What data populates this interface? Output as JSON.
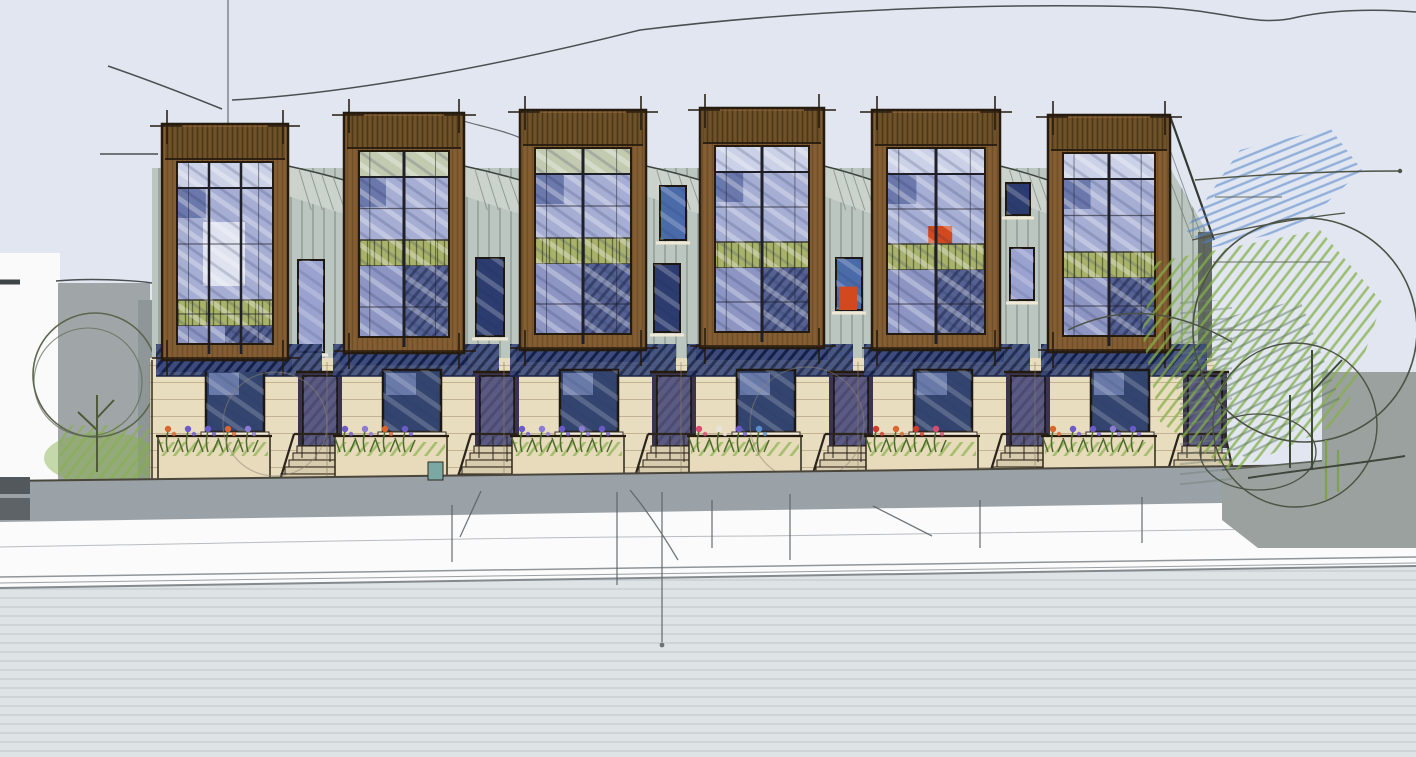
{
  "scene": {
    "type": "architectural-concept-sketch",
    "subject": "six-unit-townhouse-row-street-elevation",
    "unit_count": 6
  },
  "palette": {
    "sky": "#e1e6f1",
    "paper": "#fafafa",
    "siding": "#bcc6c0",
    "sidingLight": "#ccd4ce",
    "wood": "#855f33",
    "woodDark": "#6e5128",
    "cream": "#e9ddc0",
    "glass": "#a6aed4",
    "glassLight": "#cbd1e6",
    "glassDeep": "#8d95c3",
    "louverGreen": "#a9b26b",
    "navy": "#3b4a7c",
    "navyInk": "#141f46",
    "orange": "#d2491f",
    "door": "#6b6287",
    "doorShadow": "#3a3450",
    "step": "#d8ccae",
    "planter": "#e7dbbc",
    "sidewalk": "#9ba2a7",
    "street": "#fbfbfc",
    "foreground": "#dee3e5",
    "ink": "#241a0e",
    "pen": "#4a4e50",
    "treeOutline": "#4c5244",
    "treeGreen": "#84b048",
    "skyScribble": "#5082c8",
    "leftBuilding": "#a0a6a7",
    "rightWall": "#9aa19e",
    "flowerPurple": "#6b5bc9",
    "flowerLilac": "#8a7bd4",
    "flowerOrange": "#d9652f",
    "flowerRed": "#cf3b2a",
    "flowerPink": "#d94b70",
    "flowerWhite": "#e8e4da",
    "flowerBlue": "#5a8ec9"
  },
  "townhouses": {
    "row_left": 150,
    "row_right": 1212,
    "unit_width": 177,
    "ground_top": 358,
    "ground_bottom": 482,
    "bays": [
      {
        "x": 162,
        "w": 126,
        "top": 124,
        "bottom": 360,
        "louver": 300,
        "cols": 3,
        "topTint": false,
        "accent": false,
        "whitePanel": true
      },
      {
        "x": 344,
        "w": 120,
        "top": 113,
        "bottom": 353,
        "louver": 240,
        "cols": 2,
        "topTint": true,
        "accent": false,
        "whitePanel": false
      },
      {
        "x": 520,
        "w": 126,
        "top": 110,
        "bottom": 350,
        "louver": 238,
        "cols": 2,
        "topTint": true,
        "accent": false,
        "whitePanel": false
      },
      {
        "x": 700,
        "w": 124,
        "top": 108,
        "bottom": 348,
        "louver": 242,
        "cols": 2,
        "topTint": false,
        "accent": false,
        "whitePanel": false
      },
      {
        "x": 872,
        "w": 128,
        "top": 110,
        "bottom": 350,
        "louver": 244,
        "cols": 2,
        "topTint": false,
        "accent": true,
        "whitePanel": false
      },
      {
        "x": 1048,
        "w": 122,
        "top": 115,
        "bottom": 352,
        "louver": 252,
        "cols": 2,
        "topTint": false,
        "accent": false,
        "whitePanel": false
      }
    ],
    "gap_windows": [
      {
        "x": 298,
        "y": 260,
        "w": 26,
        "h": 92,
        "tone": "lavender",
        "accent": false
      },
      {
        "x": 476,
        "y": 258,
        "w": 28,
        "h": 78,
        "tone": "navy",
        "accent": false
      },
      {
        "x": 660,
        "y": 186,
        "w": 26,
        "h": 54,
        "tone": "blue",
        "accent": false
      },
      {
        "x": 654,
        "y": 264,
        "w": 26,
        "h": 68,
        "tone": "navy",
        "accent": false
      },
      {
        "x": 836,
        "y": 258,
        "w": 26,
        "h": 52,
        "tone": "blue",
        "accent": true
      },
      {
        "x": 1006,
        "y": 183,
        "w": 24,
        "h": 32,
        "tone": "navy",
        "accent": false
      },
      {
        "x": 1010,
        "y": 248,
        "w": 24,
        "h": 52,
        "tone": "lavender",
        "accent": false
      }
    ],
    "units": [
      {
        "flowers": [
          "flowerOrange",
          "flowerPurple",
          "flowerPurple",
          "flowerOrange",
          "flowerLilac"
        ]
      },
      {
        "flowers": [
          "flowerPurple",
          "flowerLilac",
          "flowerOrange",
          "flowerPurple"
        ]
      },
      {
        "flowers": [
          "flowerPurple",
          "flowerLilac",
          "flowerPurple",
          "flowerLilac",
          "flowerPurple"
        ]
      },
      {
        "flowers": [
          "flowerPink",
          "flowerWhite",
          "flowerPurple",
          "flowerBlue"
        ]
      },
      {
        "flowers": [
          "flowerRed",
          "flowerOrange",
          "flowerRed",
          "flowerPink"
        ]
      },
      {
        "flowers": [
          "flowerOrange",
          "flowerPurple",
          "flowerPurple",
          "flowerLilac",
          "flowerPurple"
        ]
      }
    ]
  }
}
